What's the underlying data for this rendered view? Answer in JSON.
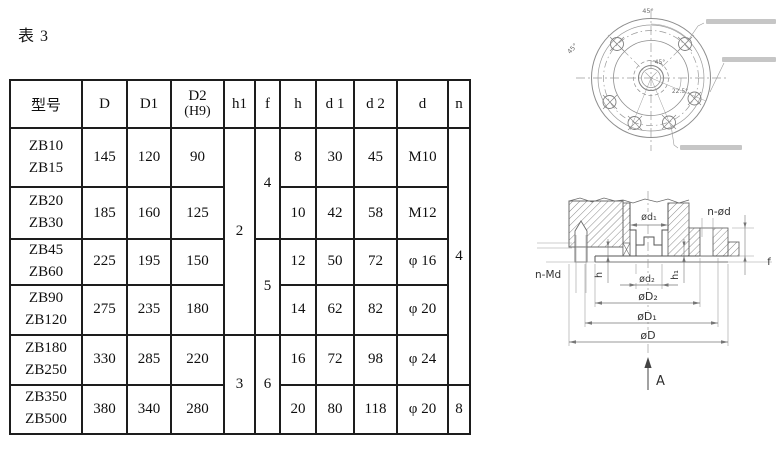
{
  "page": {
    "caption": "表 3"
  },
  "table": {
    "headers": {
      "model": "型号",
      "D": "D",
      "D1": "D1",
      "D2_line1": "D2",
      "D2_line2": "(H9)",
      "h1": "h1",
      "f": "f",
      "h": "h",
      "d1": "d 1",
      "d2": "d 2",
      "d": "d",
      "n": "n"
    },
    "rows": [
      {
        "model_top": "ZB10",
        "model_bottom": "ZB15",
        "D": "145",
        "D1": "120",
        "D2": "90",
        "h": "8",
        "d1": "30",
        "d2": "45",
        "d": "M10"
      },
      {
        "model_top": "ZB20",
        "model_bottom": "ZB30",
        "D": "185",
        "D1": "160",
        "D2": "125",
        "h": "10",
        "d1": "42",
        "d2": "58",
        "d": "M12"
      },
      {
        "model_top": "ZB45",
        "model_bottom": "ZB60",
        "D": "225",
        "D1": "195",
        "D2": "150",
        "h": "12",
        "d1": "50",
        "d2": "72",
        "d": "φ 16"
      },
      {
        "model_top": "ZB90",
        "model_bottom": "ZB120",
        "D": "275",
        "D1": "235",
        "D2": "180",
        "h": "14",
        "d1": "62",
        "d2": "82",
        "d": "φ 20"
      },
      {
        "model_top": "ZB180",
        "model_bottom": "ZB250",
        "D": "330",
        "D1": "285",
        "D2": "220",
        "h": "16",
        "d1": "72",
        "d2": "98",
        "d": "φ 24"
      },
      {
        "model_top": "ZB350",
        "model_bottom": "ZB500",
        "D": "380",
        "D1": "340",
        "D2": "280",
        "h": "20",
        "d1": "80",
        "d2": "118",
        "d": "φ 20"
      }
    ],
    "merged": {
      "h1_rows1to4": "2",
      "h1_rows5to6": "3",
      "f_rows1to2": "4",
      "f_rows3to4": "5",
      "f_rows5to6": "6",
      "n_rows1to5": "4",
      "n_row6": "8"
    }
  },
  "drawings": {
    "flange_view": {
      "angle_top": "45°",
      "angle_left": "45°",
      "angle_inner": "45°",
      "angle_lower_right": "22.5°"
    },
    "section_view": {
      "label_n_md": "n-Md",
      "label_n_od": "n-ød",
      "label_od1": "ød₁",
      "label_od2": "ød₂",
      "label_oD2": "øD₂",
      "label_oD1": "øD₁",
      "label_oD": "øD",
      "label_h": "h",
      "label_h1": "h₁",
      "label_f": "f",
      "label_view": "A"
    }
  }
}
